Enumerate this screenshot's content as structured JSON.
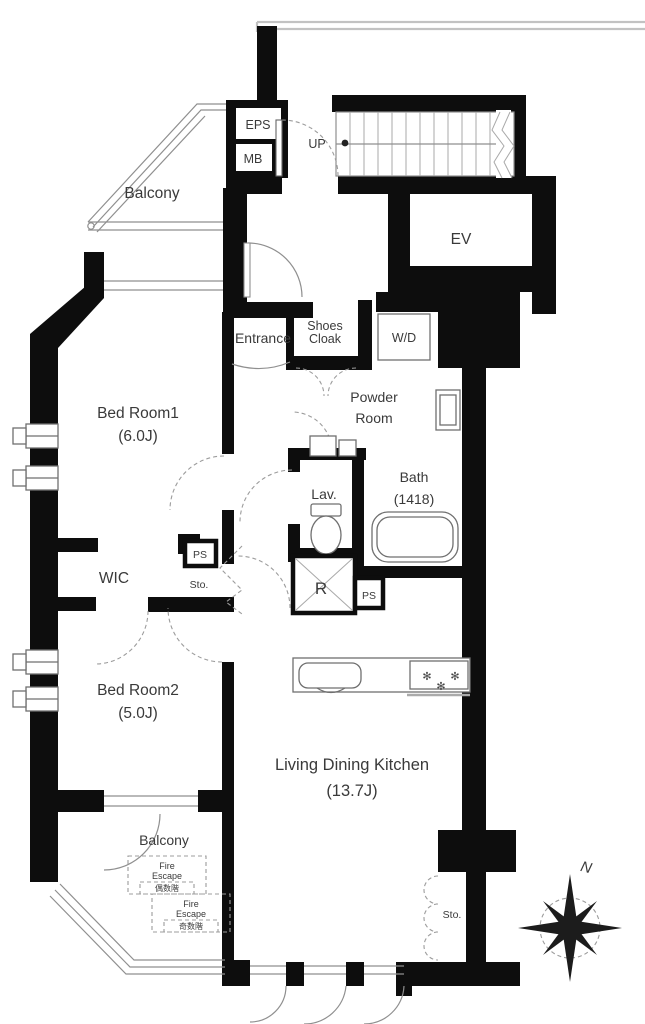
{
  "plan": {
    "type": "apartment-floor-plan",
    "colors": {
      "wall": "#0d0d0d",
      "thin_line": "#8f8f8f",
      "text": "#3a3a3a",
      "background": "#ffffff"
    },
    "labels": {
      "balcony_top": "Balcony",
      "eps": "EPS",
      "mb": "MB",
      "up": "UP",
      "ev": "EV",
      "entrance": "Entrance",
      "shoes_cloak_line1": "Shoes",
      "shoes_cloak_line2": "Cloak",
      "wd": "W/D",
      "powder_line1": "Powder",
      "powder_line2": "Room",
      "bedroom1": "Bed Room1",
      "bedroom1_size": "(6.0J)",
      "lav": "Lav.",
      "bath": "Bath",
      "bath_size": "(1418)",
      "wic": "WIC",
      "ps_upper": "PS",
      "sto_upper": "Sto.",
      "refrigerator": "R",
      "ps_lower": "PS",
      "bedroom2": "Bed Room2",
      "bedroom2_size": "(5.0J)",
      "ldk": "Living Dining Kitchen",
      "ldk_size": "(13.7J)",
      "balcony_bottom": "Balcony",
      "fire_escape1_line1": "Fire",
      "fire_escape1_line2": "Escape",
      "fire_escape1_note": "偶数階",
      "fire_escape2_line1": "Fire",
      "fire_escape2_line2": "Escape",
      "fire_escape2_note": "奇数階",
      "sto_bottom": "Sto.",
      "compass_north": "N",
      "burner_glyph": "✻"
    }
  }
}
